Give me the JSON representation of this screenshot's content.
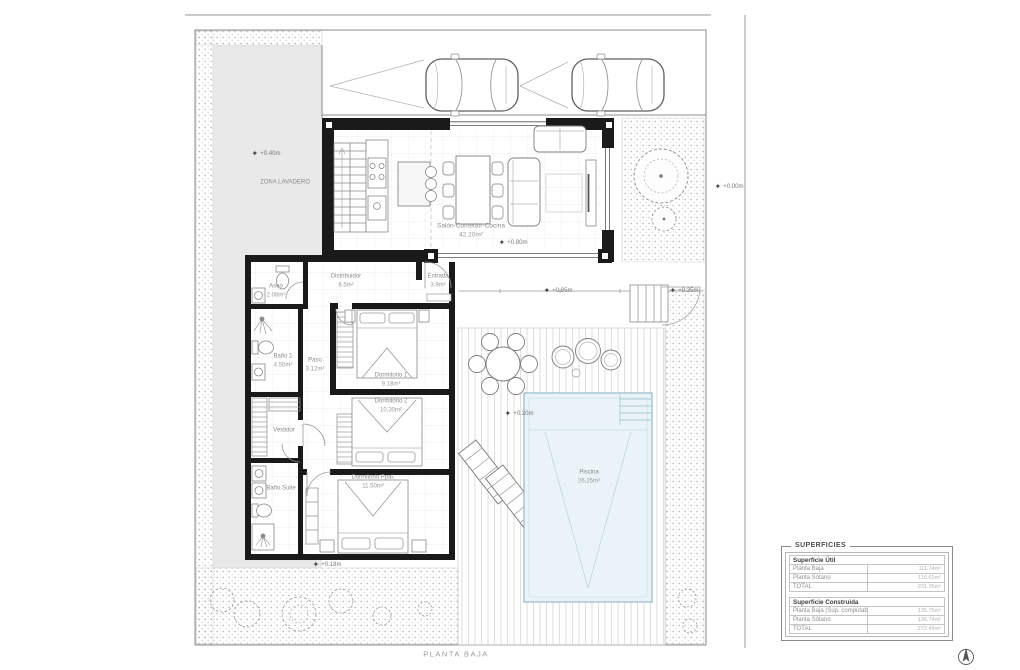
{
  "sheet": {
    "title": "PLANTA BAJA"
  },
  "rooms": {
    "lavadero": {
      "name": "ZONA LAVADERO"
    },
    "salon": {
      "name": "Salón-Comedor-Cocina",
      "area": "42.20m²"
    },
    "distribuidor country": {
      "name": ""
    },
    "distribuidor": {
      "name": "Distribuidor",
      "area": "6.5m²"
    },
    "entrada": {
      "name": "Entrada",
      "area": "3.9m²"
    },
    "aseo": {
      "name": "Aseo",
      "area": "2.08m²"
    },
    "bano1": {
      "name": "Baño 1",
      "area": "4.50m²"
    },
    "paso": {
      "name": "Paso",
      "area": "3.12m²"
    },
    "vestidor": {
      "name": "Vestidor"
    },
    "bano_suite": {
      "name": "Baño Suite"
    },
    "dorm1": {
      "name": "Dormitorio 1",
      "area": "9.18m²"
    },
    "dorm2": {
      "name": "Dormitorio 2",
      "area": "10.30m²"
    },
    "dorm_ppal": {
      "name": "Dormitorio Ppal.",
      "area": "11.50m²"
    },
    "piscina": {
      "name": "Piscina",
      "area": "26.25m²"
    }
  },
  "levels": {
    "lavadero": "+0.40m",
    "salon": "+0.80m",
    "terraza_norte": "+0.85m",
    "acceso": "+0.35m",
    "terraza": "+0.20m",
    "porche": "+0.18m",
    "calle": "+0.00m"
  },
  "superficies": {
    "title": "SUPERFICIES",
    "util": {
      "header": "Superficie Útil",
      "rows": [
        {
          "label": "Planta Baja",
          "value": "111.74m²"
        },
        {
          "label": "Planta Sótano",
          "value": "119.61m²"
        },
        {
          "label": "TOTAL",
          "value": "231.35m²"
        }
      ]
    },
    "construida": {
      "header": "Superficie Construida",
      "rows": [
        {
          "label": "Planta Baja (Sup. computable)",
          "value": "135.75m²"
        },
        {
          "label": "Planta Sótano",
          "value": "136.74m²"
        },
        {
          "label": "TOTAL",
          "value": "272.49m²"
        }
      ]
    }
  }
}
